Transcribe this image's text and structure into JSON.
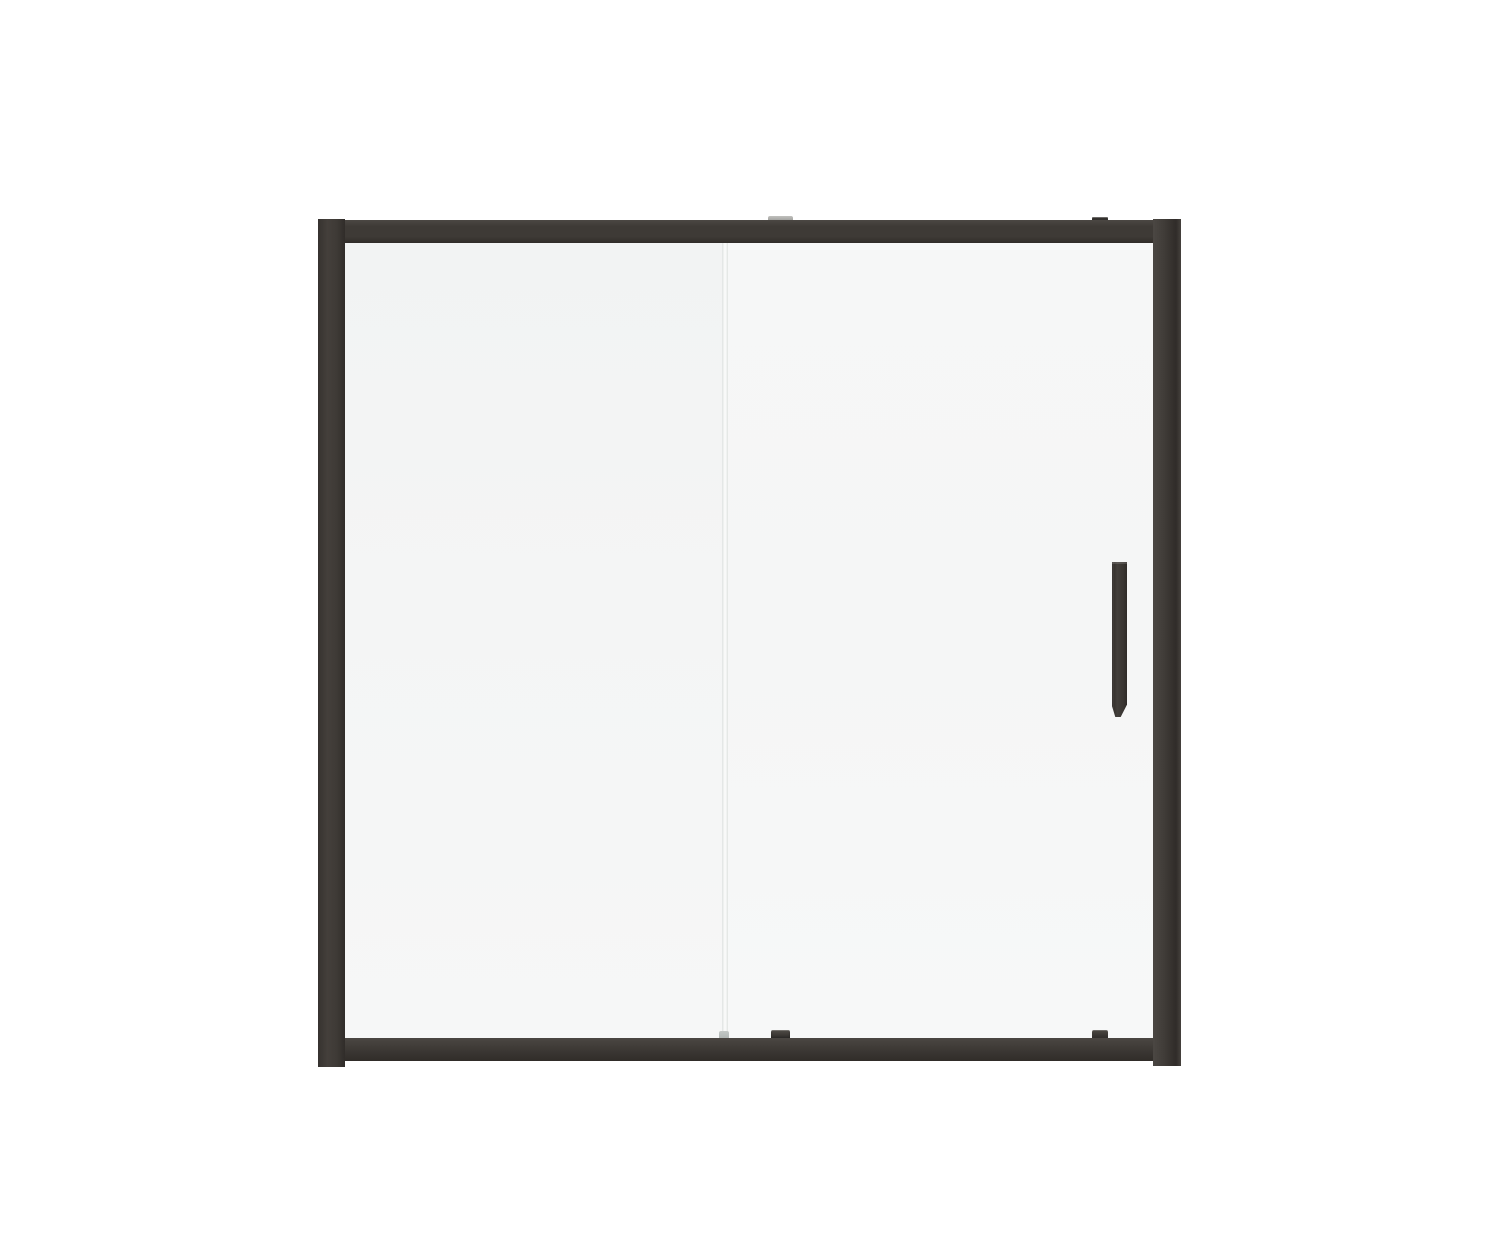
{
  "canvas": {
    "width": 1500,
    "height": 1260
  },
  "product_render": {
    "subject": "framed sliding glass shower door, front elevation, two panels, right-hand vertical pull handle",
    "panels": [
      "fixed-left-panel",
      "sliding-right-panel"
    ],
    "hardware": [
      "top-rail",
      "bottom-rail",
      "left-jamb",
      "right-jamb",
      "door-handle",
      "roller-guides"
    ]
  },
  "colors": {
    "background": "#ffffff",
    "frame": "#3e3a36",
    "frame_light": "#4b4743",
    "frame_dark": "#302c29",
    "glass_left": "#f4f5f5",
    "glass_left_top": "#f2f3f3",
    "glass_left_bottom": "#f6f7f7",
    "glass_right": "#f5f6f6",
    "glass_right_top": "#f6f7f7",
    "glass_right_bottom": "#f7f8f8",
    "seam_edge": "#dfe3e1",
    "seam_core": "#fdfdfd",
    "seam_cap": "#aeb4b2",
    "guide_light": "#8f8f8c",
    "guide_dark": "#33302d",
    "handle": "#423e3a",
    "handle_dark": "#2f2b28"
  }
}
